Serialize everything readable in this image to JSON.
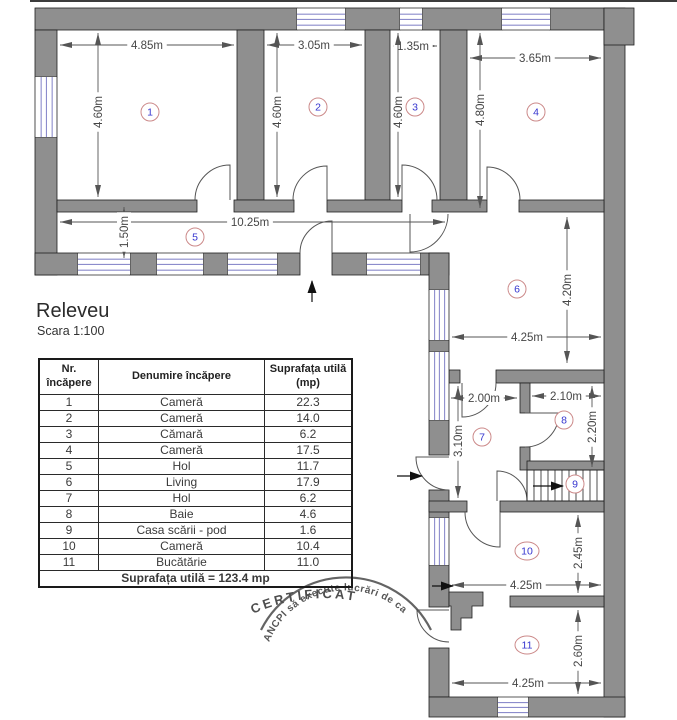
{
  "title": "Releveu",
  "scale_label": "Scara 1:100",
  "plan": {
    "room_numbers": [
      "1",
      "2",
      "3",
      "4",
      "5",
      "6",
      "7",
      "8",
      "9",
      "10",
      "11"
    ],
    "dimensions": [
      "4.85m",
      "4.60m",
      "3.05m",
      "4.60m",
      "1.35m",
      "4.60m",
      "3.65m",
      "4.80m",
      "10.25m",
      "1.50m",
      "4.20m",
      "4.25m",
      "2.00m",
      "3.10m",
      "2.10m",
      "2.20m",
      "2.45m",
      "4.25m",
      "2.60m",
      "4.25m"
    ]
  },
  "table": {
    "col1_header": "Nr.\nîncăpere",
    "col2_header": "Denumire încăpere",
    "col3_header": "Suprafața utilă\n(mp)",
    "rows": [
      {
        "nr": "1",
        "name": "Cameră",
        "area": "22.3"
      },
      {
        "nr": "2",
        "name": "Cameră",
        "area": "14.0"
      },
      {
        "nr": "3",
        "name": "Cămară",
        "area": "6.2"
      },
      {
        "nr": "4",
        "name": "Cameră",
        "area": "17.5"
      },
      {
        "nr": "5",
        "name": "Hol",
        "area": "11.7"
      },
      {
        "nr": "6",
        "name": "Living",
        "area": "17.9"
      },
      {
        "nr": "7",
        "name": "Hol",
        "area": "6.2"
      },
      {
        "nr": "8",
        "name": "Baie",
        "area": "4.6"
      },
      {
        "nr": "9",
        "name": "Casa scării - pod",
        "area": "1.6"
      },
      {
        "nr": "10",
        "name": "Cameră",
        "area": "10.4"
      },
      {
        "nr": "11",
        "name": "Bucătărie",
        "area": "11.0"
      }
    ],
    "footer": "Suprafața utilă = 123.4 mp"
  },
  "stamp": {
    "arc_text": "ANCPI să execute lucrări de ca",
    "center_text": "CERTIFICAT"
  },
  "colors": {
    "wall_gray": "#8f8f8f",
    "window_blue": "#8c8ccc",
    "room_number_blue": "#3535cf",
    "room_circle_red": "#cc8a8a",
    "dimension_gray": "#464646"
  }
}
